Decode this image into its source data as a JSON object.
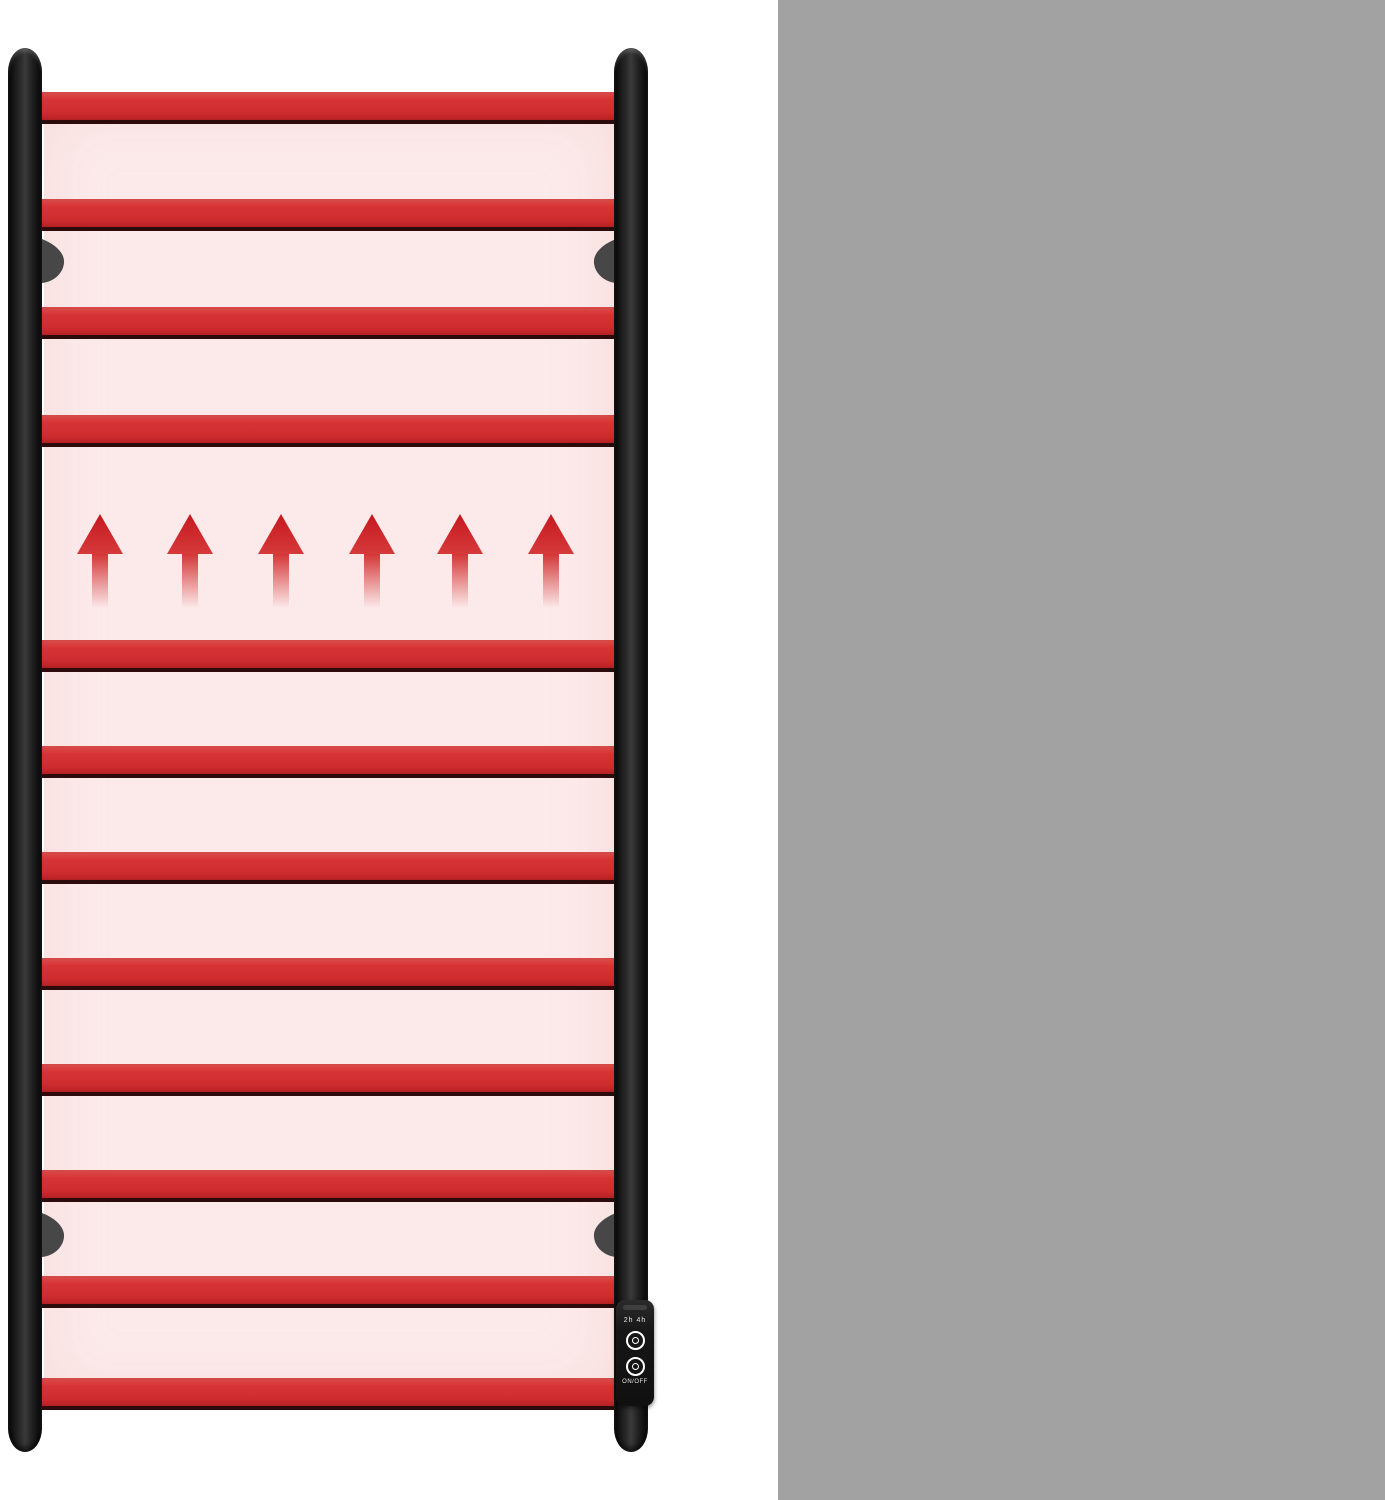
{
  "figure": {
    "name": "heated towel rail",
    "bar_count": 12,
    "heat_arrow_count": 6,
    "colors": {
      "bar_red": "#d02d30",
      "panel_pink": "#fceaea",
      "rail_black": "#1a1a1a",
      "sidebar_gray": "#a2a2a2",
      "text_white": "#ffffff"
    },
    "control_panel": {
      "timer_label": "2h 4h",
      "power_label": "ON/OFF"
    }
  },
  "sidebar": {
    "features": [
      {
        "icon": "thermometer-icon",
        "value": "15",
        "unit": "min",
        "label_lines": [
          "Quick Heat Within"
        ]
      },
      {
        "icon": "heating-power-sensor-icon",
        "value": "120",
        "unit": "Watts",
        "label_lines": [
          "Heating Power"
        ]
      },
      {
        "icon": "overheat-protection-clock-icon",
        "value": "",
        "unit": "",
        "label_lines": [
          "Overheat",
          "Protection"
        ]
      }
    ]
  }
}
